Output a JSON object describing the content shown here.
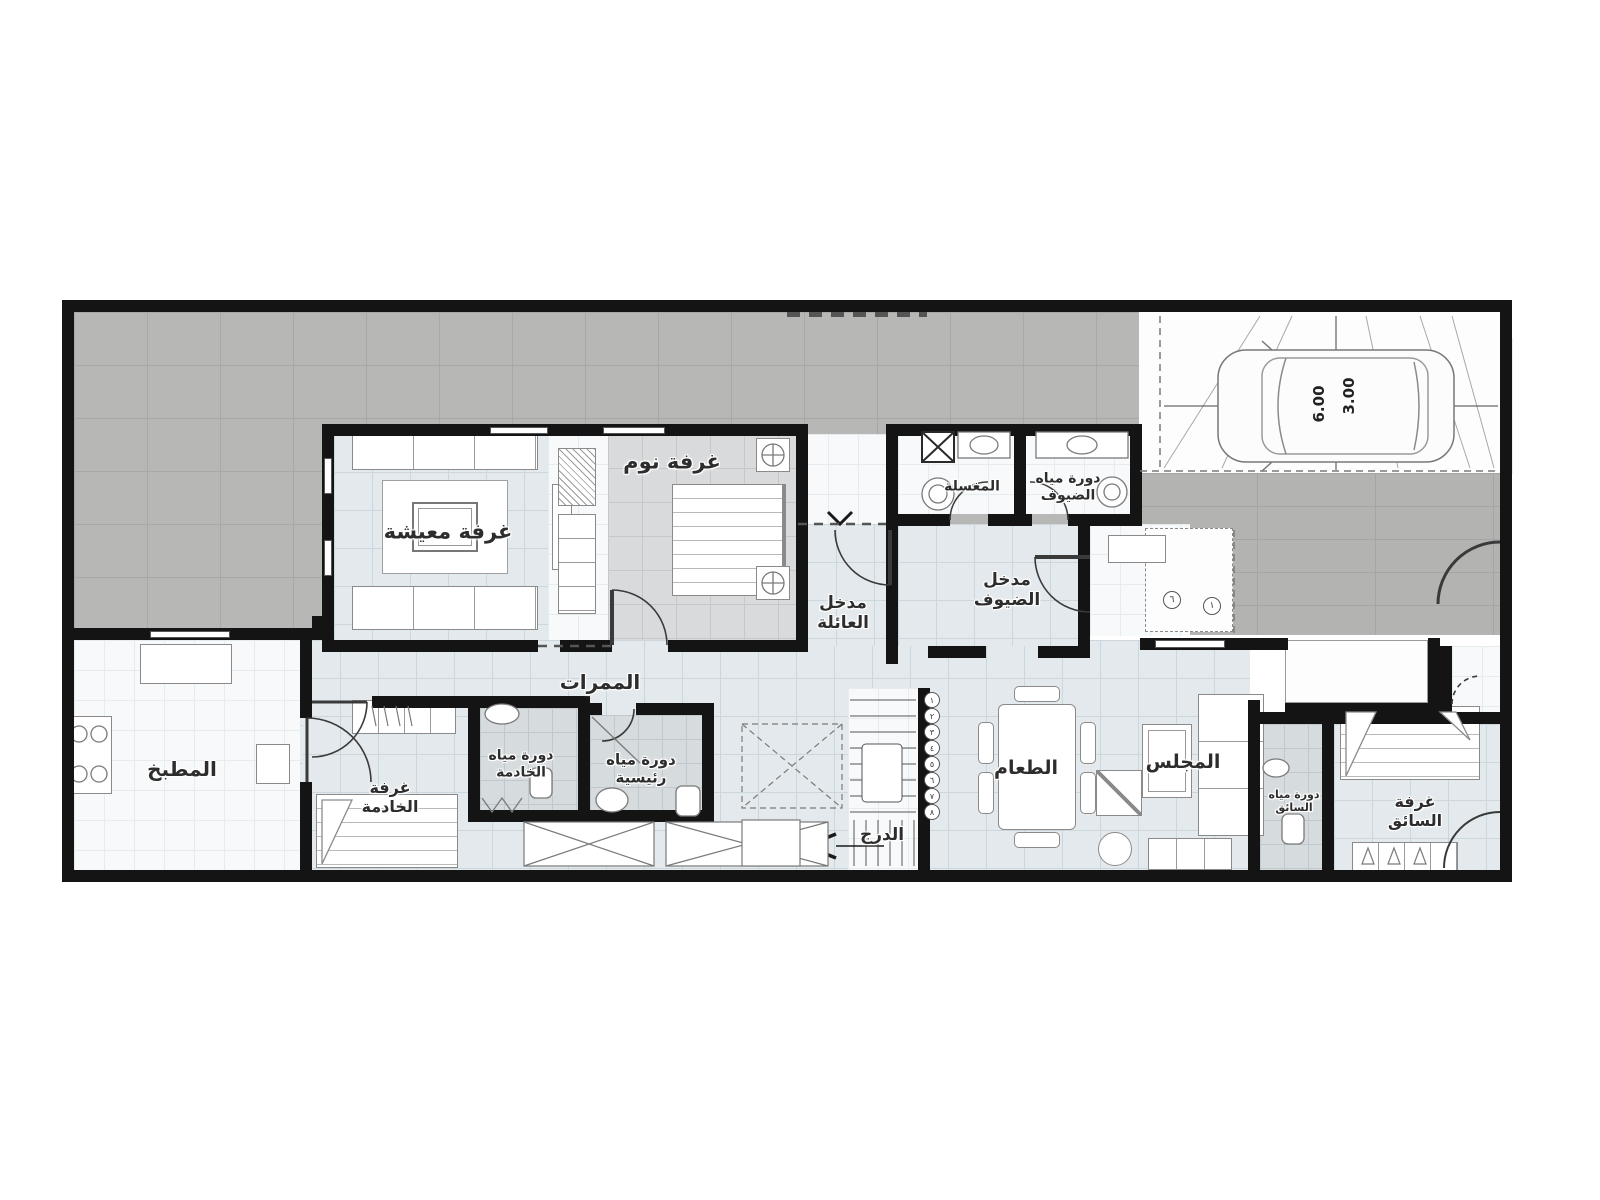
{
  "plan": {
    "labels": {
      "living_room": "غرفة معيشة",
      "bedroom": "غرفة نوم",
      "family_entrance": "مدخل\nالعائلة",
      "laundry": "المغسلة",
      "guest_wc": "دورة مياه\nالضيوف",
      "guest_entrance": "مدخل\nالضيوف",
      "corridors": "الممرات",
      "kitchen": "المطبخ",
      "maid_room": "غرفة\nالخادمة",
      "maid_wc": "دورة مياه\nالخادمة",
      "master_wc": "دورة مياه\nرئيسية",
      "stairs": "الدرج",
      "dining": "الطعام",
      "majlis": "المجلس",
      "driver_wc": "دورة مياه\nالسائق",
      "driver_room": "غرفة\nالسائق"
    },
    "parking": {
      "length": "6.00",
      "width": "3.00"
    },
    "keynotes": [
      "٦",
      "١"
    ],
    "stair_steps": [
      "١",
      "٢",
      "٣",
      "٤",
      "٥",
      "٦",
      "٧",
      "٨"
    ],
    "colors": {
      "wall": "#141414",
      "courtyard": "#b7b7b6",
      "floor": "#e3e9ec",
      "bedroom_floor": "#d9dadb",
      "wet_floor": "#d6dbdd"
    }
  }
}
